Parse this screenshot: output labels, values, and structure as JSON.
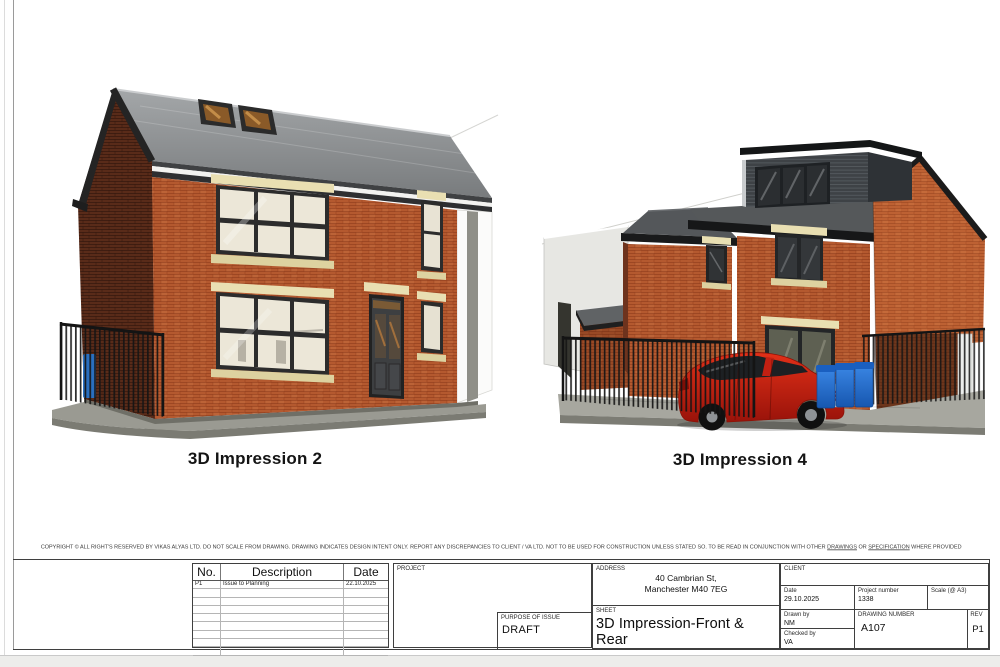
{
  "palette": {
    "paper": "#ffffff",
    "line": "#3f3f3f",
    "text": "#1a1a1a",
    "brick_bright": "#b4592f",
    "brick_dark": "#6d351f",
    "roof_light": "#9a9da0",
    "roof_dark": "#54575a",
    "trim_dark": "#1a1a1a",
    "stone": "#e9dfb2",
    "glass_warm": "#ece7d8",
    "glass_cool": "#2b2e31",
    "cladding": "#3e4246",
    "ground": "#a7a79f",
    "plinth": "#6f6f67",
    "fence": "#141414",
    "car_red": "#cf2012",
    "bin_blue": "#1f6fd0",
    "neighbor": "#e7e7e3"
  },
  "figures": {
    "fig1": {
      "caption": "3D Impression 2"
    },
    "fig2": {
      "caption": "3D Impression 4"
    }
  },
  "copyright": {
    "part1": "COPYRIGHT © ALL RIGHT'S RESERVED BY VIKAS ALYAS LTD. DO NOT SCALE FROM DRAWING. DRAWING INDICATES DESIGN INTENT ONLY. REPORT ANY DISCREPANCIES TO CLIENT / VA LTD. NOT TO BE USED FOR CONSTRUCTION UNLESS STATED SO. TO BE READ IN CONJUNCTION WITH OTHER ",
    "underlined1": "DRAWINGS",
    "part2": " OR ",
    "underlined2": "SPECIFICATION",
    "part3": " WHERE PROVIDED"
  },
  "title_block": {
    "revision_table": {
      "headers": [
        "No.",
        "Description",
        "Date"
      ],
      "rows": [
        {
          "no": "P1",
          "description": "Issue to Planning",
          "date": "22.10.2025"
        }
      ],
      "empty_rows": 8
    },
    "project": {
      "label": "PROJECT",
      "value": ""
    },
    "purpose": {
      "label": "PURPOSE OF ISSUE",
      "value": "DRAFT"
    },
    "address": {
      "label": "ADDRESS",
      "line1": "40 Cambrian St,",
      "line2": "Manchester M40 7EG"
    },
    "sheet": {
      "label": "SHEET",
      "value": "3D Impression-Front & Rear"
    },
    "client": {
      "label": "CLIENT",
      "value": ""
    },
    "date": {
      "label": "Date",
      "value": "29.10.2025"
    },
    "project_number": {
      "label": "Project number",
      "value": "1338"
    },
    "scale": {
      "label": "Scale (@ A3)",
      "value": ""
    },
    "drawn_by": {
      "label": "Drawn by",
      "value": "NM"
    },
    "checked_by": {
      "label": "Checked by",
      "value": "VA"
    },
    "drawing_number": {
      "label": "DRAWING NUMBER",
      "value": "A107"
    },
    "rev": {
      "label": "REV",
      "value": "P1"
    }
  }
}
